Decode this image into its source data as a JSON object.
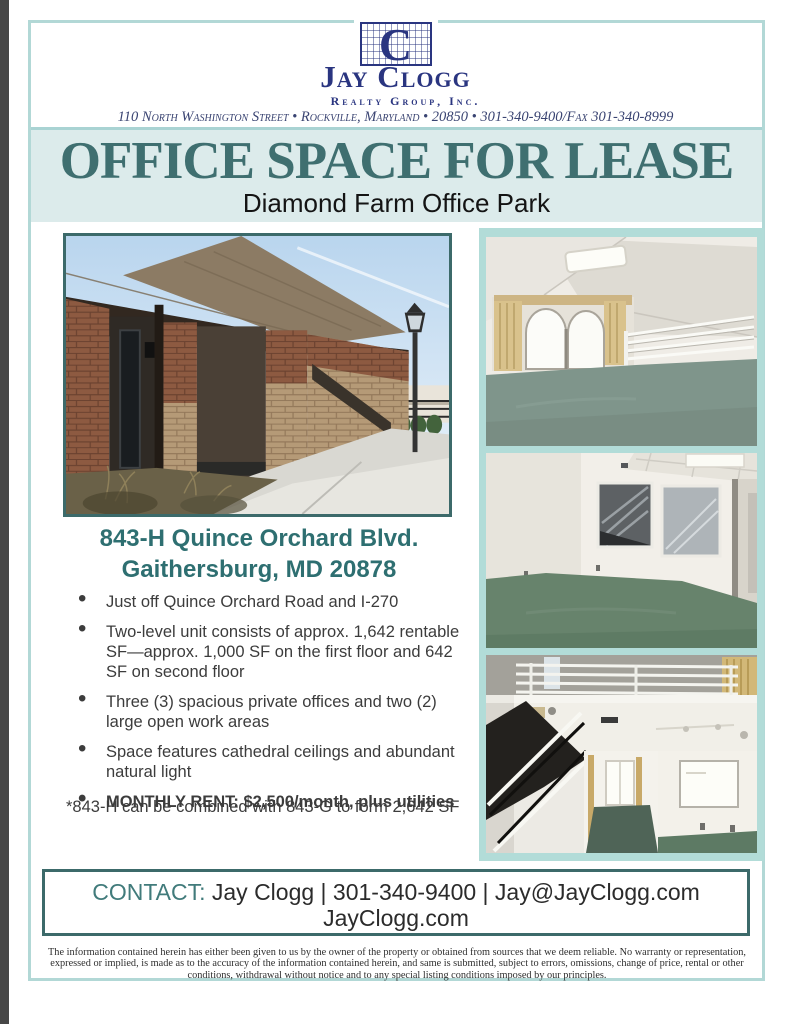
{
  "colors": {
    "navy": "#2a3580",
    "teal_dark": "#3c6a6a",
    "teal_heading": "#3f6f70",
    "teal_property": "#2e6f71",
    "title_band_bg": "#dcebeb",
    "photo_column_bg": "#b2dcd8",
    "frame_border": "#b2d8d6"
  },
  "header": {
    "logo": {
      "letter": "C",
      "company": "Jay Clogg",
      "subtitle": "Realty Group, Inc."
    },
    "address_line": "110 North Washington Street • Rockville, Maryland • 20850 • 301-340-9400/Fax 301-340-8999"
  },
  "hero": {
    "title": "OFFICE SPACE FOR LEASE",
    "subtitle": "Diamond Farm Office Park"
  },
  "property": {
    "address_line1": "843-H Quince Orchard Blvd.",
    "address_line2": "Gaithersburg, MD 20878"
  },
  "bullets": [
    {
      "text": "Just off Quince Orchard Road and I-270",
      "bold": false
    },
    {
      "text": "Two-level unit consists of approx. 1,642 rentable SF—approx. 1,000 SF on the first floor and 642 SF on second floor",
      "bold": false
    },
    {
      "text": "Three (3) spacious private offices and two (2) large open work areas",
      "bold": false
    },
    {
      "text": "Space features cathedral ceilings and abundant natural light",
      "bold": false
    },
    {
      "text": "MONTHLY RENT: $2,500/month, plus utilities",
      "bold": true
    }
  ],
  "note": "*843-H can be combined with 843-G to form 2,642 SF",
  "contact": {
    "label": "CONTACT:",
    "info": " Jay Clogg | 301-340-9400 | Jay@JayClogg.com",
    "website": "JayClogg.com"
  },
  "disclaimer": "The information contained herein has either been given to us by the owner of the property or obtained from sources that we deem reliable.  No warranty or representation, expressed or implied, is made as to the accuracy of the information contained herein, and same is submitted, subject to errors, omissions, change of price, rental or other conditions, withdrawal without notice and to any special listing conditions imposed by our principles.",
  "photos": {
    "main_alt": "brick office building exterior with covered entry walkway and lamp post",
    "stack_alts": [
      "upstairs loft with cathedral ceiling, arched window and green carpet",
      "open office room with interior glass windows and green carpet",
      "two-level interior with staircase, mezzanine railing and offices"
    ]
  }
}
